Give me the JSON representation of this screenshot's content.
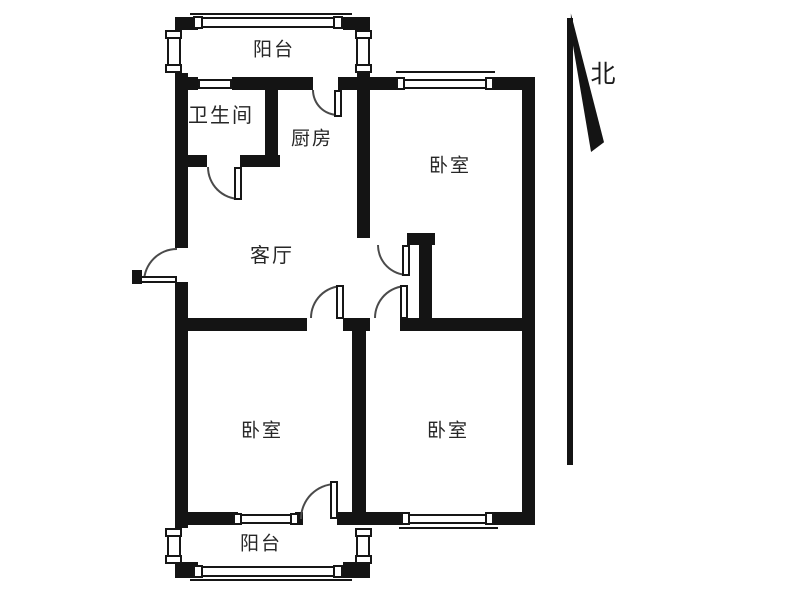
{
  "meta": {
    "drawing_type": "apartment-floor-plan",
    "background_color": "#ffffff",
    "wall_color": "#141414",
    "line_color": "#4a4a4a",
    "label_color": "#262626"
  },
  "compass": {
    "label": "北",
    "x": 603,
    "y": 75,
    "font_size": 25
  },
  "rooms": [
    {
      "id": "balcony-top",
      "label": "阳台",
      "cx": 274,
      "cy": 50,
      "font_size": 19
    },
    {
      "id": "bathroom",
      "label": "卫生间",
      "cx": 221,
      "cy": 116,
      "font_size": 20
    },
    {
      "id": "kitchen",
      "label": "厨房",
      "cx": 312,
      "cy": 139,
      "font_size": 19
    },
    {
      "id": "bedroom-top-right",
      "label": "卧室",
      "cx": 450,
      "cy": 166,
      "font_size": 19
    },
    {
      "id": "living-room",
      "label": "客厅",
      "cx": 272,
      "cy": 256,
      "font_size": 20
    },
    {
      "id": "bedroom-bottom-left",
      "label": "卧室",
      "cx": 262,
      "cy": 431,
      "font_size": 19
    },
    {
      "id": "bedroom-bottom-right",
      "label": "卧室",
      "cx": 448,
      "cy": 431,
      "font_size": 19
    },
    {
      "id": "balcony-bottom",
      "label": "阳台",
      "cx": 261,
      "cy": 544,
      "font_size": 19
    }
  ],
  "walls": [
    [
      175,
      17,
      23,
      13
    ],
    [
      343,
      17,
      27,
      13
    ],
    [
      175,
      73,
      13,
      17
    ],
    [
      357,
      73,
      13,
      17
    ],
    [
      175,
      77,
      23,
      13
    ],
    [
      232,
      77,
      81,
      13
    ],
    [
      338,
      77,
      62,
      13
    ],
    [
      490,
      77,
      45,
      13
    ],
    [
      175,
      90,
      13,
      158
    ],
    [
      175,
      282,
      13,
      230
    ],
    [
      522,
      77,
      13,
      443
    ],
    [
      265,
      90,
      13,
      72
    ],
    [
      183,
      155,
      24,
      12
    ],
    [
      240,
      155,
      40,
      12
    ],
    [
      357,
      90,
      13,
      148
    ],
    [
      407,
      233,
      28,
      12
    ],
    [
      419,
      233,
      13,
      97
    ],
    [
      183,
      318,
      124,
      13
    ],
    [
      343,
      318,
      27,
      13
    ],
    [
      400,
      318,
      122,
      13
    ],
    [
      352,
      325,
      14,
      193
    ],
    [
      183,
      512,
      55,
      13
    ],
    [
      295,
      512,
      8,
      13
    ],
    [
      337,
      512,
      68,
      13
    ],
    [
      490,
      512,
      45,
      13
    ],
    [
      175,
      512,
      13,
      16
    ],
    [
      175,
      562,
      23,
      16
    ],
    [
      343,
      562,
      27,
      16
    ]
  ],
  "windows": [
    {
      "name": "balcony-top-window",
      "body": [
        198,
        17,
        145,
        11
      ],
      "caps": [
        [
          193,
          16,
          10,
          13
        ],
        [
          333,
          16,
          10,
          13
        ]
      ],
      "outer": [
        190,
        13,
        162,
        2
      ]
    },
    {
      "name": "balcony-top-side-window-left",
      "body": [
        167,
        30,
        14,
        43
      ],
      "caps": [
        [
          165,
          30,
          17,
          9
        ],
        [
          165,
          64,
          17,
          9
        ]
      ],
      "outer": null
    },
    {
      "name": "balcony-top-side-window-right",
      "body": [
        356,
        30,
        14,
        43
      ],
      "caps": [
        [
          355,
          30,
          17,
          9
        ],
        [
          355,
          64,
          17,
          9
        ]
      ],
      "outer": null
    },
    {
      "name": "bathroom-window",
      "body": [
        198,
        79,
        34,
        10
      ],
      "caps": [],
      "outer": null
    },
    {
      "name": "bedroom-top-right-window",
      "body": [
        400,
        79,
        90,
        10
      ],
      "caps": [
        [
          396,
          77,
          9,
          13
        ],
        [
          485,
          77,
          9,
          13
        ]
      ],
      "outer": [
        396,
        71,
        99,
        2
      ]
    },
    {
      "name": "bedroom-bottom-left-window",
      "body": [
        238,
        514,
        57,
        10
      ],
      "caps": [
        [
          233,
          513,
          9,
          12
        ],
        [
          290,
          513,
          9,
          12
        ]
      ],
      "outer": null
    },
    {
      "name": "bedroom-bottom-right-window",
      "body": [
        405,
        514,
        85,
        10
      ],
      "caps": [
        [
          401,
          512,
          9,
          13
        ],
        [
          485,
          512,
          9,
          13
        ]
      ],
      "outer": [
        399,
        527,
        99,
        2
      ]
    },
    {
      "name": "balcony-bottom-window",
      "body": [
        198,
        566,
        145,
        11
      ],
      "caps": [
        [
          193,
          565,
          10,
          13
        ],
        [
          333,
          565,
          10,
          13
        ]
      ],
      "outer": [
        190,
        579,
        162,
        2
      ]
    },
    {
      "name": "balcony-bottom-side-window-left",
      "body": [
        167,
        528,
        14,
        34
      ],
      "caps": [
        [
          165,
          528,
          17,
          9
        ],
        [
          165,
          555,
          17,
          9
        ]
      ],
      "outer": null
    },
    {
      "name": "balcony-bottom-side-window-right",
      "body": [
        356,
        528,
        14,
        34
      ],
      "caps": [
        [
          355,
          528,
          17,
          9
        ],
        [
          355,
          555,
          17,
          9
        ]
      ],
      "outer": null
    }
  ],
  "doors": [
    {
      "name": "entrance-door",
      "arc": [
        143,
        248,
        34,
        "tl"
      ],
      "leaf": [
        140,
        276,
        37,
        7
      ],
      "cap": [
        132,
        270,
        10,
        14
      ]
    },
    {
      "name": "bathroom-door",
      "arc": [
        207,
        167,
        33,
        "bl"
      ],
      "leaf": [
        234,
        167,
        8,
        33
      ],
      "cap": null
    },
    {
      "name": "kitchen-balcony-door",
      "arc": [
        312,
        90,
        26,
        "bl"
      ],
      "leaf": [
        334,
        90,
        8,
        27
      ],
      "cap": null
    },
    {
      "name": "bedroom-top-right-door",
      "arc": [
        377,
        245,
        31,
        "bl"
      ],
      "leaf": [
        402,
        245,
        8,
        31
      ],
      "cap": null
    },
    {
      "name": "bedroom-bottom-right-door",
      "arc": [
        374,
        285,
        33,
        "tl"
      ],
      "leaf": [
        400,
        285,
        8,
        34
      ],
      "cap": null
    },
    {
      "name": "bedroom-bottom-left-door",
      "arc": [
        310,
        285,
        33,
        "tl"
      ],
      "leaf": [
        336,
        285,
        8,
        34
      ],
      "cap": null
    },
    {
      "name": "balcony-bottom-door",
      "arc": [
        300,
        483,
        36,
        "tl"
      ],
      "leaf": [
        330,
        481,
        8,
        38
      ],
      "cap": null
    }
  ],
  "north_arrow": {
    "staff": [
      567,
      18,
      6,
      447
    ],
    "wedge": {
      "box": [
        568,
        12,
        36,
        140
      ],
      "points": "8% 1%, 100% 93%, 64% 100%, 8% 15%"
    }
  }
}
